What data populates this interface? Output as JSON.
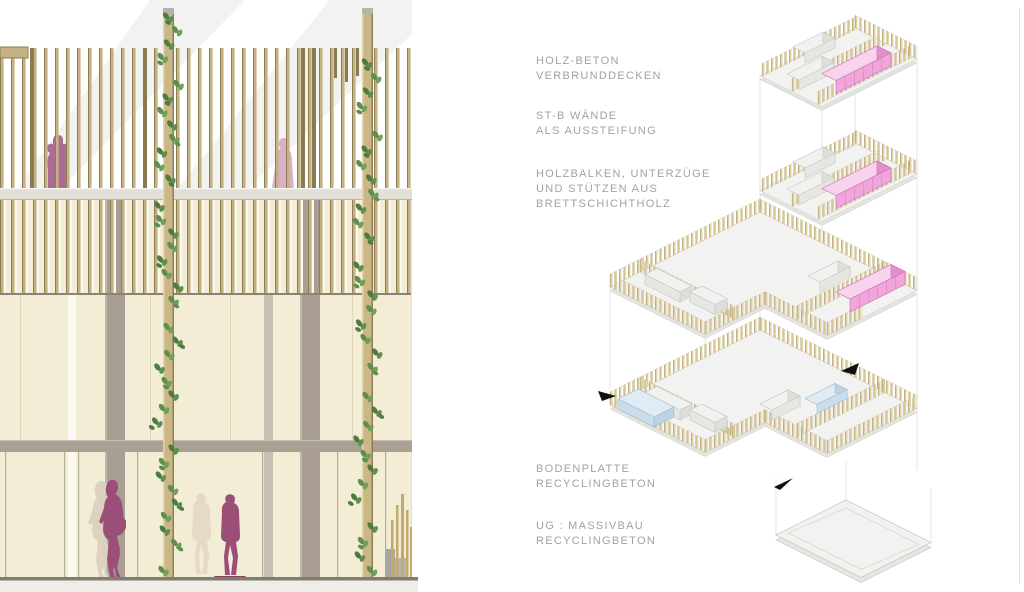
{
  "page": {
    "background": "#ffffff",
    "border_line_color": "#e2e2de"
  },
  "elevation": {
    "description": "facade elevation with timber slat screens, climbing vines and human figures",
    "colors": {
      "slat_tan": "#c4b282",
      "cream_wall": "#f2edd4",
      "column_taupe": "#a89e93",
      "figure_plum": "#9b4e78",
      "figure_terrace_left": "#ab6d94",
      "figure_terrace_right": "#d9afc9",
      "figure_shadow": "#ddd2c0",
      "vine_green": "#5e8f4d",
      "ground_line": "#817d71"
    }
  },
  "axonometric": {
    "description": "exploded structural axonometric of timber building",
    "labels": [
      {
        "id": "holz-beton",
        "lines": [
          "HOLZ-BETON",
          "VERBRUNDDECKEN"
        ]
      },
      {
        "id": "stb-waende",
        "lines": [
          "ST-B WÄNDE",
          "ALS AUSSTEIFUNG"
        ]
      },
      {
        "id": "holzbalken",
        "lines": [
          "HOLZBALKEN, UNTERZÜGE",
          "UND STÜTZEN AUS",
          "BRETTSCHICHTHOLZ"
        ]
      },
      {
        "id": "bodenplatte",
        "lines": [
          "BODENPLATTE",
          "RECYCLINGBETON"
        ]
      },
      {
        "id": "ug-massivbau",
        "lines": [
          "UG : MASSIVBAU",
          "RECYCLINGBETON"
        ]
      }
    ],
    "colors": {
      "stb_wall_pink": "#f0a6d8",
      "highlight_blue": "#c9ddeb",
      "timber_slat": "#dfd2a8",
      "plate_gray": "#f2f2f0"
    }
  }
}
